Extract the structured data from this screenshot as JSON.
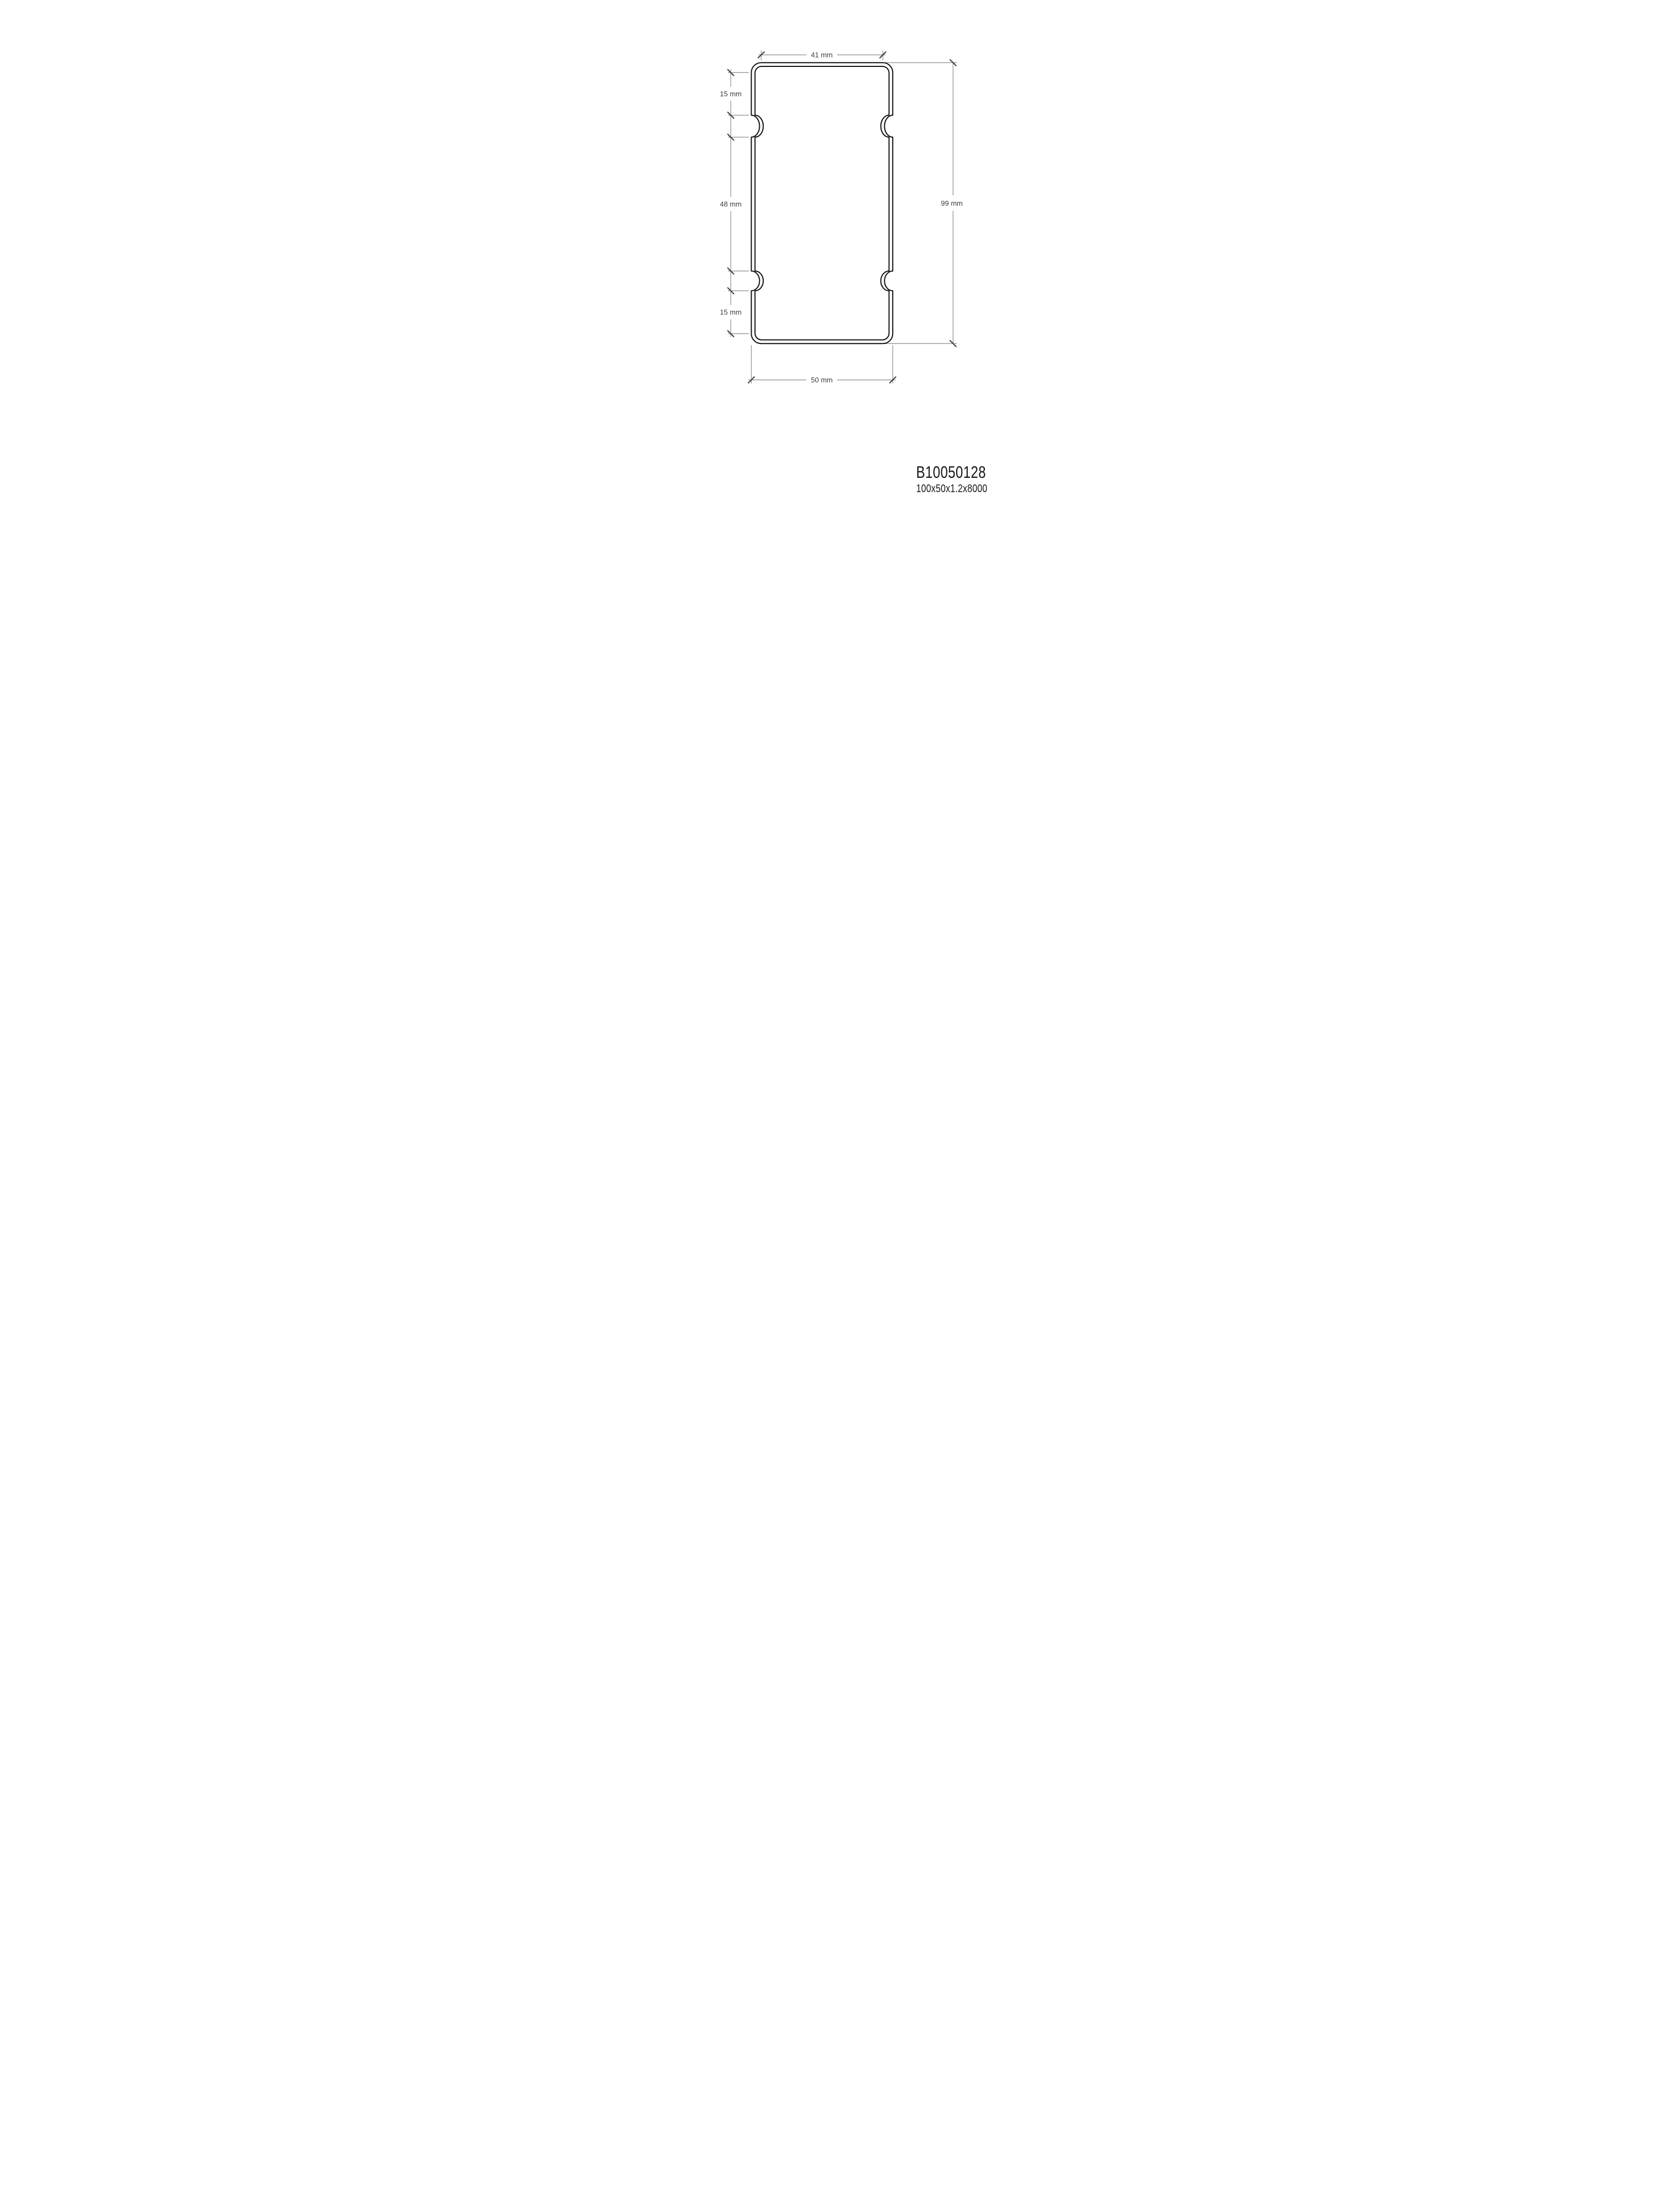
{
  "drawing": {
    "type": "profile-cross-section",
    "dimensions": {
      "top_width": "41 mm",
      "upper_side": "15 mm",
      "middle_side": "48 mm",
      "lower_side": "15 mm",
      "overall_height": "99 mm",
      "bottom_width": "50 mm"
    },
    "product": {
      "code": "B10050128",
      "spec": "100x50x1.2x8000"
    },
    "colors": {
      "background": "#ffffff",
      "outline": "#121212",
      "dimension_line": "#8c8c8c",
      "tick": "#3f3f3f",
      "dimension_text": "#3d3d3d",
      "label_text": "#161616"
    }
  }
}
